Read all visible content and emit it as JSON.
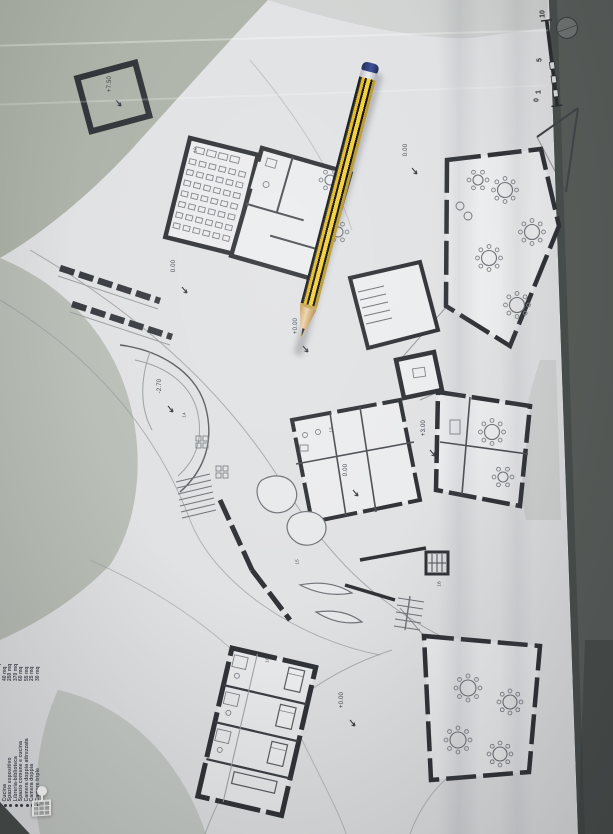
{
  "legend": {
    "items": [
      {
        "label": "Servizi",
        "area": "245 mq"
      },
      {
        "label": "Cucina",
        "area": "40 mq"
      },
      {
        "label": "Spazio espositivo",
        "area": "250 mq"
      },
      {
        "label": "Libreria-biblioteca",
        "area": "370 mq"
      },
      {
        "label": "Spazio comune e cucina",
        "area": "60 mq"
      },
      {
        "label": "Camera doppia attrezzata",
        "area": "55 mq"
      },
      {
        "label": "Camera doppia",
        "area": "25 mq"
      },
      {
        "label": "Camere triple",
        "area": "30 mq"
      }
    ]
  },
  "spot_levels": {
    "patio": "+7.50",
    "path_upper": "0.00",
    "terrace_upper": "0.00",
    "entry_mid": "+0.00",
    "court": "-2.70",
    "wing_right": "+3.00",
    "hall_central": "0.00",
    "hall_lower": "+0.00"
  },
  "room_numbers": {
    "auditorium": "10",
    "court_side": "14",
    "r13": "13",
    "r15": "15",
    "r16": "16",
    "r18": "18"
  },
  "scale_bar": {
    "top": "10",
    "mid": "5",
    "zero": "0",
    "one": "1"
  },
  "icons": {
    "building_pin": "building-pin-icon"
  },
  "colors": {
    "paper": "#e1e2e4",
    "terrain": "#a9b0a4",
    "table": "#8f968d",
    "table_dark": "#565b58",
    "wall": "#303337",
    "pencil_yellow": "#e8c531",
    "pencil_black": "#141418",
    "pencil_cap": "#2e3f7e"
  }
}
